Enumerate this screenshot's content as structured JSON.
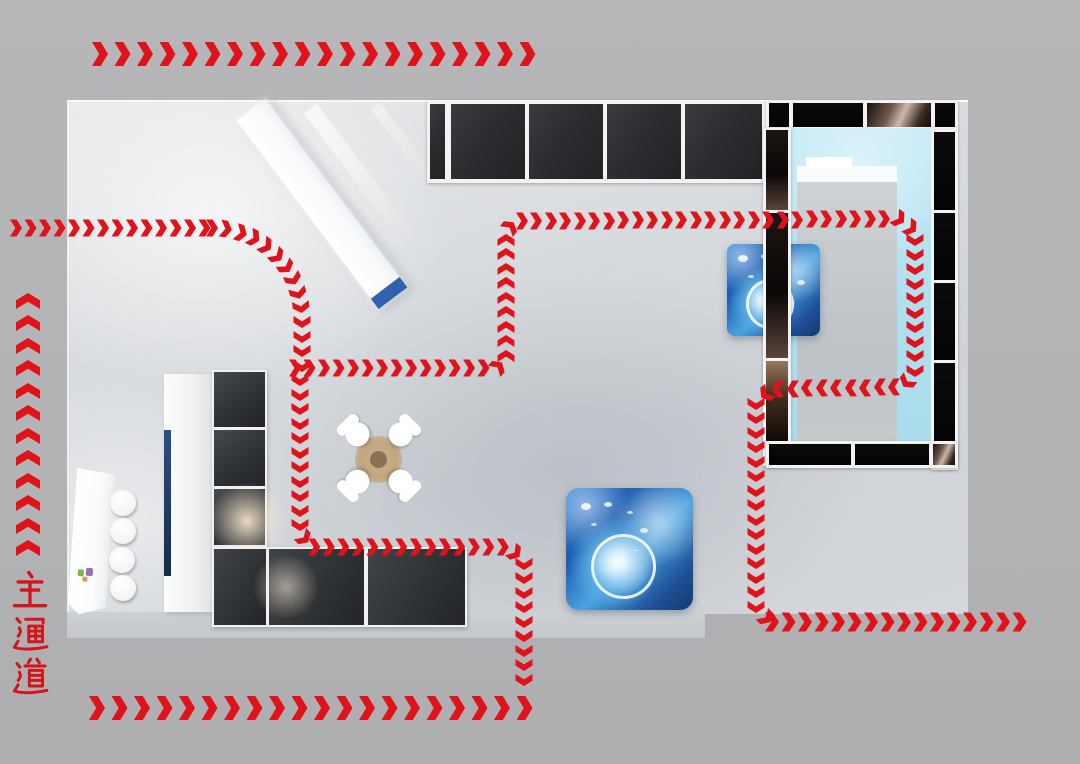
{
  "scene": {
    "name": "exhibition-booth-circulation-floorplan"
  },
  "labels": {
    "main_aisle": "主通道"
  },
  "colors": {
    "background": "#b3b4b6",
    "floor": "#d6d9dc",
    "arrow_red": "#e0131b",
    "label_red": "#d4161b",
    "panel_dark": "#2e3033",
    "panel_black": "#070707",
    "bronze_highlight": "#cdb7a7",
    "pool_blue": "#b2e1ef",
    "screen_blue": "#1b66bd",
    "table_tan": "#c2a67f",
    "desk_cap_blue": "#2f63ae"
  },
  "flow": {
    "sizes": {
      "S": {
        "w": 12,
        "h": 17,
        "gap": 14.5
      },
      "M": {
        "w": 14,
        "h": 19,
        "gap": 16.5
      },
      "L": {
        "w": 16,
        "h": 24,
        "gap": 22.5
      }
    },
    "paths": [
      {
        "name": "main-aisle-top",
        "size": "L",
        "type": "poly",
        "points": [
          [
            100,
            54
          ],
          [
            532,
            54
          ]
        ]
      },
      {
        "name": "main-aisle-left",
        "size": "L",
        "type": "poly",
        "points": [
          [
            28,
            548
          ],
          [
            28,
            286
          ]
        ]
      },
      {
        "name": "main-aisle-bottom",
        "size": "L",
        "type": "poly",
        "points": [
          [
            97,
            708
          ],
          [
            532,
            708
          ]
        ]
      },
      {
        "name": "entry-west",
        "size": "S",
        "type": "poly",
        "points": [
          [
            16,
            228
          ],
          [
            212,
            228
          ]
        ]
      },
      {
        "name": "entry-west-curve",
        "size": "S",
        "type": "arc",
        "cx": 212,
        "cy": 318,
        "r": 90,
        "a0": -90,
        "a1": 0
      },
      {
        "name": "entry-west-down",
        "size": "S",
        "type": "poly",
        "points": [
          [
            302,
            322
          ],
          [
            302,
            366
          ]
        ]
      },
      {
        "name": "inner-loop-north",
        "size": "S",
        "type": "poly",
        "points": [
          [
            295,
            368
          ],
          [
            497,
            368
          ],
          [
            506,
            358
          ],
          [
            506,
            232
          ],
          [
            515,
            221
          ],
          [
            898,
            219
          ],
          [
            915,
            231
          ],
          [
            915,
            371
          ],
          [
            903,
            387
          ],
          [
            772,
            389
          ],
          [
            756,
            402
          ],
          [
            756,
            607
          ],
          [
            768,
            620
          ]
        ]
      },
      {
        "name": "exit-east",
        "size": "M",
        "type": "poly",
        "points": [
          [
            772,
            622
          ],
          [
            1030,
            622
          ]
        ]
      },
      {
        "name": "inner-loop-south",
        "size": "S",
        "type": "poly",
        "points": [
          [
            300,
            380
          ],
          [
            300,
            534
          ],
          [
            312,
            547
          ],
          [
            508,
            547
          ],
          [
            524,
            561
          ],
          [
            524,
            684
          ]
        ]
      }
    ]
  }
}
